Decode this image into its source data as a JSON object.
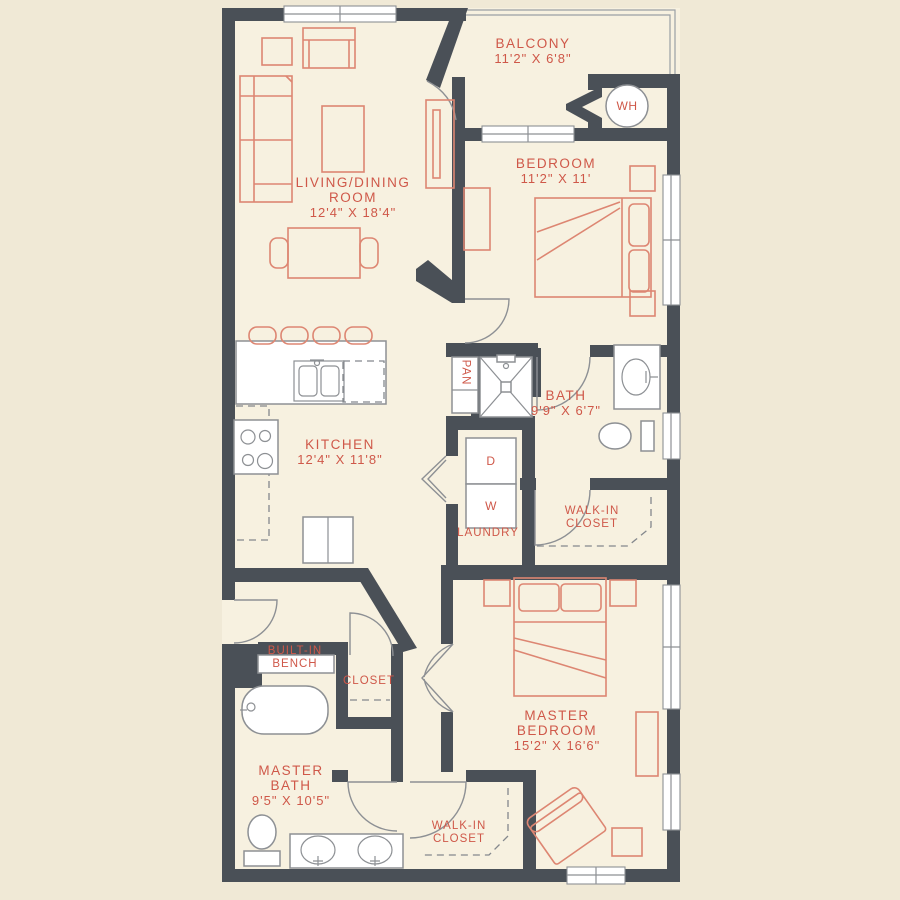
{
  "plan_title": "Two bedroom two bath apartment floor plan",
  "colors": {
    "background": "#f0e9d6",
    "floor": "#f7f1e0",
    "wall": "#4a5057",
    "label_text": "#cf5849",
    "furniture_line": "#dd8672",
    "fixture_outline": "#8d9094"
  },
  "rooms": {
    "balcony": {
      "name": "BALCONY",
      "dims": "11'2\" X 6'8\""
    },
    "water_heater": {
      "name": "WH"
    },
    "bedroom": {
      "name": "BEDROOM",
      "dims": "11'2\" X 11'"
    },
    "living": {
      "name1": "LIVING/DINING",
      "name2": "ROOM",
      "dims": "12'4\" X 18'4\""
    },
    "kitchen": {
      "name": "KITCHEN",
      "dims": "12'4\" X 11'8\""
    },
    "pantry": {
      "name": "PAN"
    },
    "bath": {
      "name": "BATH",
      "dims": "9'9\" X 6'7\""
    },
    "laundry": {
      "name": "LAUNDRY",
      "dryer": "D",
      "washer": "W"
    },
    "walk_in_closet_upper": {
      "name1": "WALK-IN",
      "name2": "CLOSET"
    },
    "built_in_bench": {
      "name1": "BUILT-IN",
      "name2": "BENCH"
    },
    "closet": {
      "name": "CLOSET"
    },
    "master_bath": {
      "name1": "MASTER",
      "name2": "BATH",
      "dims": "9'5\" X 10'5\""
    },
    "master_bedroom": {
      "name1": "MASTER",
      "name2": "BEDROOM",
      "dims": "15'2\" X 16'6\""
    },
    "walk_in_closet_lower": {
      "name1": "WALK-IN",
      "name2": "CLOSET"
    }
  }
}
